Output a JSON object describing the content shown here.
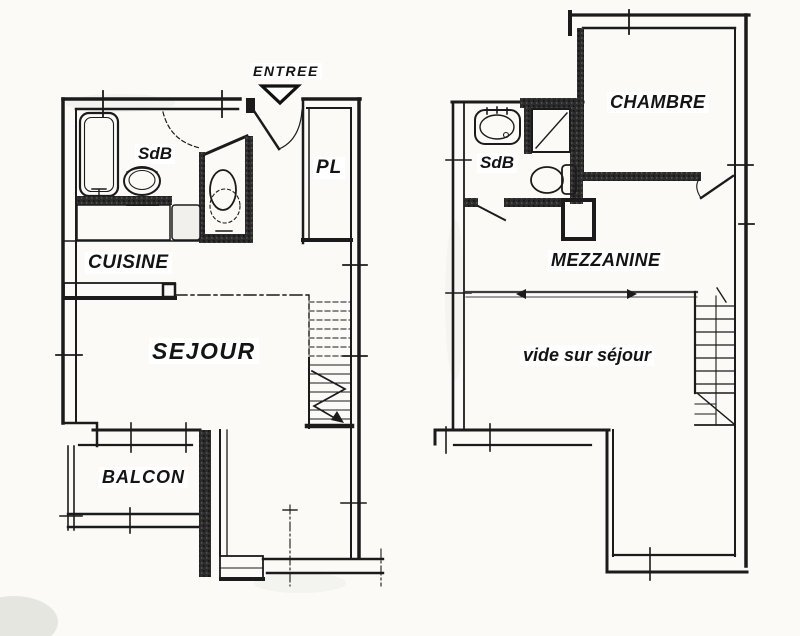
{
  "scan": {
    "background_color": "#fbfaf7",
    "ink_color": "#1b1b1b",
    "label_background": "#ffffff"
  },
  "plans": {
    "floor1": {
      "labels": {
        "entree": "ENTREE",
        "sdb": "SdB",
        "pl": "PL",
        "cuisine": "CUISINE",
        "sejour": "SEJOUR",
        "balcon": "BALCON"
      },
      "fixtures": [
        "bathtub",
        "washbasin",
        "toilet",
        "kitchen-counter",
        "entry-door",
        "stairs"
      ]
    },
    "floor2": {
      "labels": {
        "chambre": "CHAMBRE",
        "sdb": "SdB",
        "mezzanine": "MEZZANINE",
        "vide_sur_sejour": "vide sur séjour"
      },
      "fixtures": [
        "washbasin",
        "shower",
        "toilet",
        "door",
        "stairs"
      ]
    }
  },
  "icons": {
    "entry_direction_arrow": "triangle-down",
    "mezzanine_edge_arrows": "left-right-ticks"
  }
}
